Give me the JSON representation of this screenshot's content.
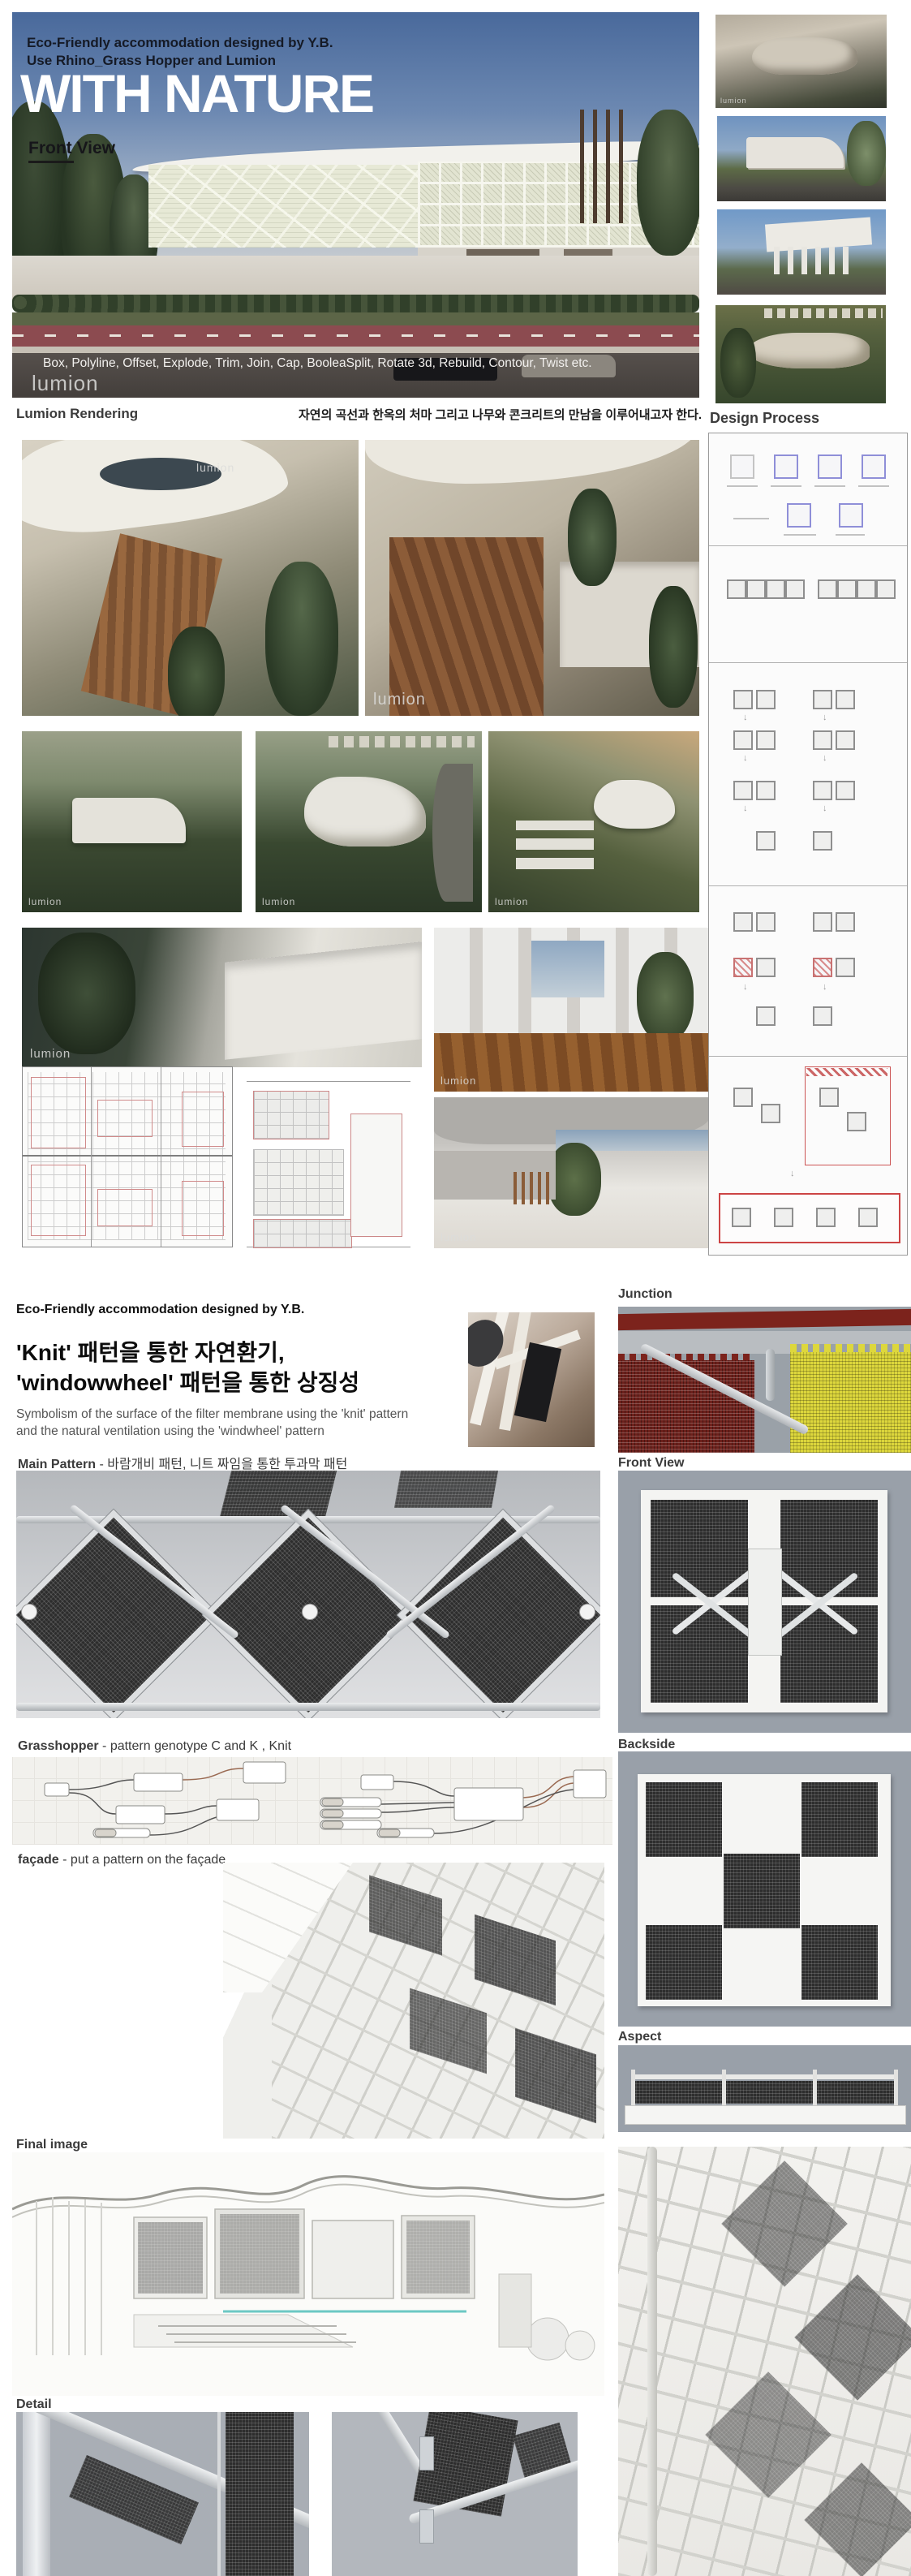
{
  "shared": {
    "watermark": "lumion",
    "icons": {
      "down_arrow": "↓"
    }
  },
  "page1": {
    "banner": {
      "title_line1": "Eco-Friendly accommodation designed by Y.B.",
      "title_line2": "Use Rhino_Grass Hopper and Lumion",
      "headline": "WITH NATURE",
      "view_label": "Front View",
      "tools_text": "Box, Polyline, Offset, Explode, Trim, Join, Cap, BooleaSplit, Rotate 3d, Rebuild, Contour, Twist etc."
    },
    "lumion_section": {
      "label": "Lumion Rendering",
      "caption_ko": "자연의 곡선과 한옥의 처마 그리고 나무와 콘크리트의 만남을 이루어내고자 한다."
    },
    "design_process": {
      "title": "Design Process"
    }
  },
  "page2": {
    "title": "Eco-Friendly accommodation designed by Y.B.",
    "heading_line1": "'Knit' 패턴을 통한 자연환기,",
    "heading_line2": "'windowwheel' 패턴을 통한 상징성",
    "subtext_line1": "Symbolism of the surface of the filter membrane using the 'knit' pattern",
    "subtext_line2": "and the natural ventilation using the 'windwheel' pattern",
    "sections": {
      "junction": "Junction",
      "front_view": "Front View",
      "main_pattern_bold": "Main Pattern",
      "main_pattern_rest": " - 바람개비 패턴, 니트 짜임을 통한 투과막 패턴",
      "grasshopper_bold": "Grasshopper",
      "grasshopper_rest": " - pattern genotype C and K , Knit",
      "backside": "Backside",
      "facade_bold": "façade",
      "facade_rest": " - put a pattern on the façade",
      "aspect": "Aspect",
      "final_image": "Final image",
      "detail": "Detail"
    }
  },
  "colors": {
    "sky": "#49699b",
    "road": "#4a4542",
    "bike_lane": "#8c4b50",
    "process_square_border": "#8f8fd8",
    "process_hatch": "#c87272",
    "junction_red": "#7c231c",
    "junction_yellow": "#ddd73c",
    "teal_accent": "#6cc8c4"
  }
}
